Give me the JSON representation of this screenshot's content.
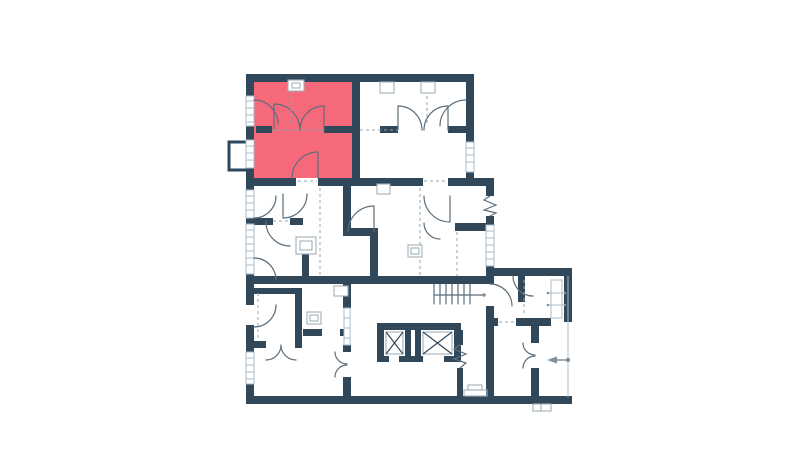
{
  "app": {
    "title": "Apartment floor plan",
    "description": "2D architectural floor plan of a residential storey with one apartment unit highlighted in red"
  },
  "colors": {
    "background": "#ffffff",
    "wall": "#31485b",
    "highlight": "#f5697b",
    "door": "#5b6e7b",
    "window": "#a9bcc9",
    "dash": "#93a4af",
    "fixture": "#9fb0ba",
    "annotation": "#7f909b"
  },
  "plan": {
    "highlighted_unit": {
      "name": "highlighted apartment unit",
      "position": "upper-left of plan",
      "color": "#f5697b"
    },
    "features": [
      "exterior walls",
      "interior partition walls",
      "windows on exterior walls",
      "door swing arcs",
      "double entrance doors",
      "accordion folding doors",
      "balcony at upper-left",
      "staircase",
      "two elevator shafts with cross marks",
      "ventilation shafts",
      "entrance direction arrow at lower-right",
      "dashed ceiling/opening guides"
    ]
  }
}
